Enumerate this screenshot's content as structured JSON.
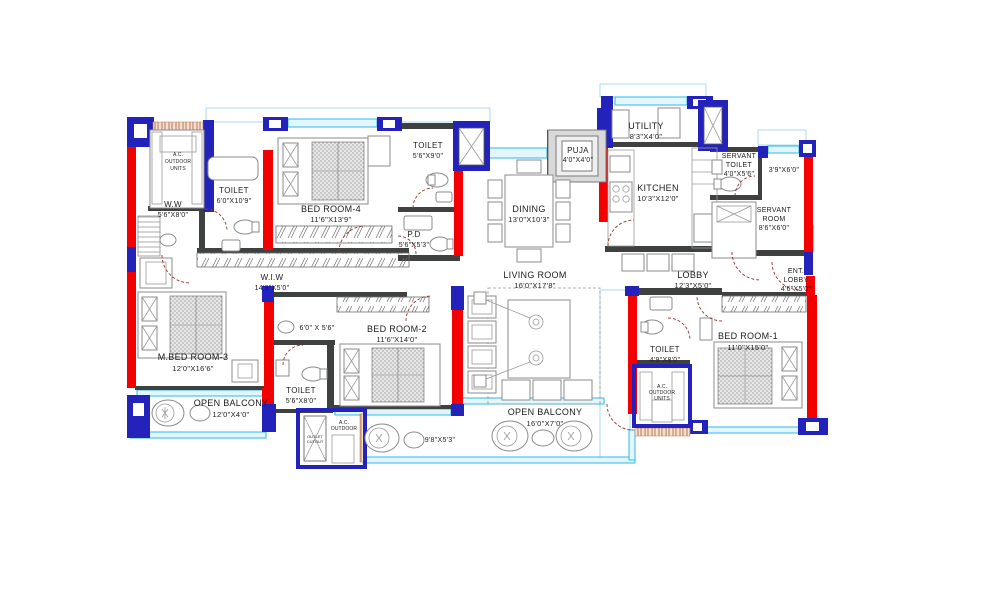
{
  "colors": {
    "wall_red": "#f40000",
    "wall_blue": "#2323bb",
    "wall_dark": "#3f4040",
    "window_cyan": "#31b8e8",
    "door_arc": "#90362a",
    "hatch_brown": "#b97a56",
    "text": "#1d1d1d",
    "background": "#ffffff"
  },
  "rooms": {
    "ac_tl": {
      "l1": "A.C.",
      "l2": "OUTDOOR",
      "l3": "UNITS"
    },
    "ww": {
      "l1": "W.W",
      "l2": "5'6\"X8'0\""
    },
    "toilet_ww": {
      "l1": "TOILET",
      "l2": "6'0\"X10'9\""
    },
    "bedroom4": {
      "l1": "BED ROOM-4",
      "l2": "11'6\"X13'9\""
    },
    "toilet_b4": {
      "l1": "TOILET",
      "l2": "5'6\"X9'0\""
    },
    "pd": {
      "l1": "P.D",
      "l2": "5'6\"X5'3\""
    },
    "puja": {
      "l1": "PUJA",
      "l2": "4'0\"X4'0\""
    },
    "dining": {
      "l1": "DINING",
      "l2": "13'0\"X10'3\""
    },
    "utility": {
      "l1": "UTILITY",
      "l2": "8'3\"X4'0\""
    },
    "kitchen": {
      "l1": "KITCHEN",
      "l2": "10'3\"X12'0\""
    },
    "servant_toilet": {
      "l1": "SERVANT",
      "l2": "TOILET",
      "l3": "4'0\"X5'6\""
    },
    "passage": {
      "l1": "3'9\"X6'0\""
    },
    "servant_room": {
      "l1": "SERVANT",
      "l2": "ROOM",
      "l3": "8'6\"X6'0\""
    },
    "lobby": {
      "l1": "LOBBY",
      "l2": "12'3\"X5'0\""
    },
    "ent_lobby": {
      "l1": "ENT.",
      "l2": "LOBBY",
      "l3": "4'6\"X5'0\""
    },
    "wiw": {
      "l1": "W.I.W",
      "l2": "14'9\"X5'0\""
    },
    "living": {
      "l1": "LIVING ROOM",
      "l2": "16'0\"X17'8\""
    },
    "mbed3": {
      "l1": "M.BED ROOM-3",
      "l2": "12'0\"X16'6\""
    },
    "dress": {
      "l1": "6'0\" X 5'6\""
    },
    "bedroom2": {
      "l1": "BED ROOM-2",
      "l2": "11'6\"X14'0\""
    },
    "toilet_b2": {
      "l1": "TOILET",
      "l2": "5'6\"X8'0\""
    },
    "balcony1": {
      "l1": "OPEN BALCONY",
      "l2": "12'0\"X4'0\""
    },
    "ac_bottom": {
      "l1": "A.C.",
      "l2": "OUTDOOR",
      "l3": "UNITS"
    },
    "balcony2": {
      "l1": "OPEN BALCONY",
      "l2": "16'0\"X7'0\""
    },
    "balcony2_dim": {
      "l1": "9'8\"X5'3\""
    },
    "toilet_b1": {
      "l1": "TOILET",
      "l2": "4'9\"X8'0\""
    },
    "ac_right": {
      "l1": "A.C.",
      "l2": "OUTDOOR",
      "l3": "UNITS"
    },
    "bedroom1": {
      "l1": "BED ROOM-1",
      "l2": "11'0\"X15'0\""
    }
  },
  "annotations": {
    "outlet_cutout_1": "OUTLET",
    "outlet_cutout_2": "CUTOUT"
  }
}
